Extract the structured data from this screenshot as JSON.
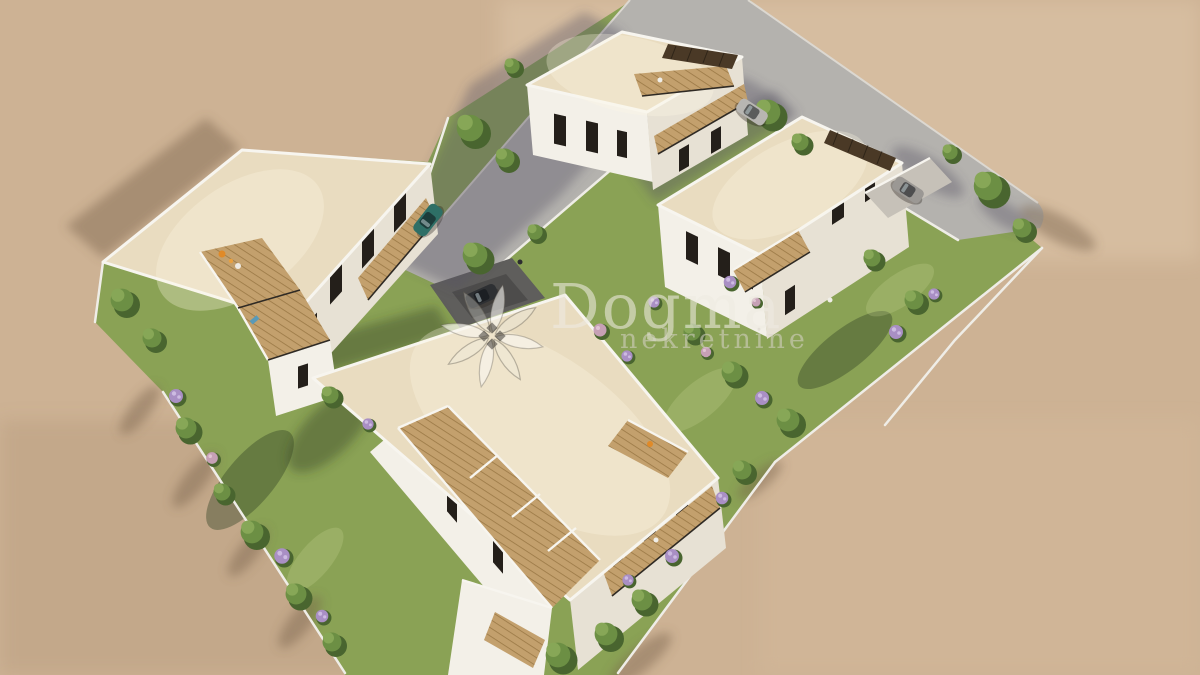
{
  "image": {
    "kind": "aerial 3D architectural rendering",
    "subject": "Residential development of four white flat-roofed apartment buildings with gardens, wooden roof terraces, an L-shaped street and parked cars, surrounded by empty sandy ground",
    "view": "high-angle aerial view"
  },
  "watermark": {
    "brand": "Dogma",
    "subtitle": "nekretnine",
    "logo": "pinwheel-flower-logo"
  },
  "palette": {
    "sand": "#cdb294",
    "sand_light": "#dcc6a6",
    "road": "#b4b2ae",
    "lawn": "#8aa255",
    "lawn_light": "#9db36a",
    "tree": "#6c8f44",
    "tree_dark": "#49652f",
    "tree_light": "#87a757",
    "flower_purple": "#a98fc4",
    "flower_pink": "#c6a0b5",
    "roof": "#e9dcc0",
    "wall": "#f3f0e8",
    "wall_shade": "#e7e1d4",
    "parapet": "#f7f5ef",
    "window": "#241f1a",
    "wood": "#c3a06d",
    "wood_dark": "#9a7845",
    "pergola": "#4a3926",
    "fence": "#efede7",
    "drive_dark": "#5f5e5c",
    "car_teal": "#2e6f66",
    "car_silver": "#b8b6b2",
    "car_gray": "#9b9894",
    "car_black": "#2e3033"
  },
  "objects": {
    "buildings": [
      {
        "id": "north-building",
        "label": "Three-storey apartment building with rooftop pergola and wood balconies"
      },
      {
        "id": "west-building",
        "label": "Apartment building with stepped wooden roof terraces and balconies"
      },
      {
        "id": "east-building",
        "label": "Apartment building with dark pergola, balcony deck and carport"
      },
      {
        "id": "south-building",
        "label": "Large apartment building with long stepped terrace decks"
      }
    ],
    "cars": [
      {
        "color_name": "teal",
        "location": "street west of the north building"
      },
      {
        "color_name": "silver",
        "location": "driveway beside the north building"
      },
      {
        "color_name": "gray",
        "location": "carport beside the east building"
      },
      {
        "color_name": "black",
        "location": "dark drive north of the south building"
      }
    ],
    "ground": [
      "sandy vacant land",
      "L-shaped asphalt street",
      "lawn gardens",
      "white boundary fences",
      "cast shadows"
    ],
    "vegetation": [
      "green trees",
      "shrubs",
      "purple flowering bushes",
      "pink flowering bushes"
    ]
  }
}
